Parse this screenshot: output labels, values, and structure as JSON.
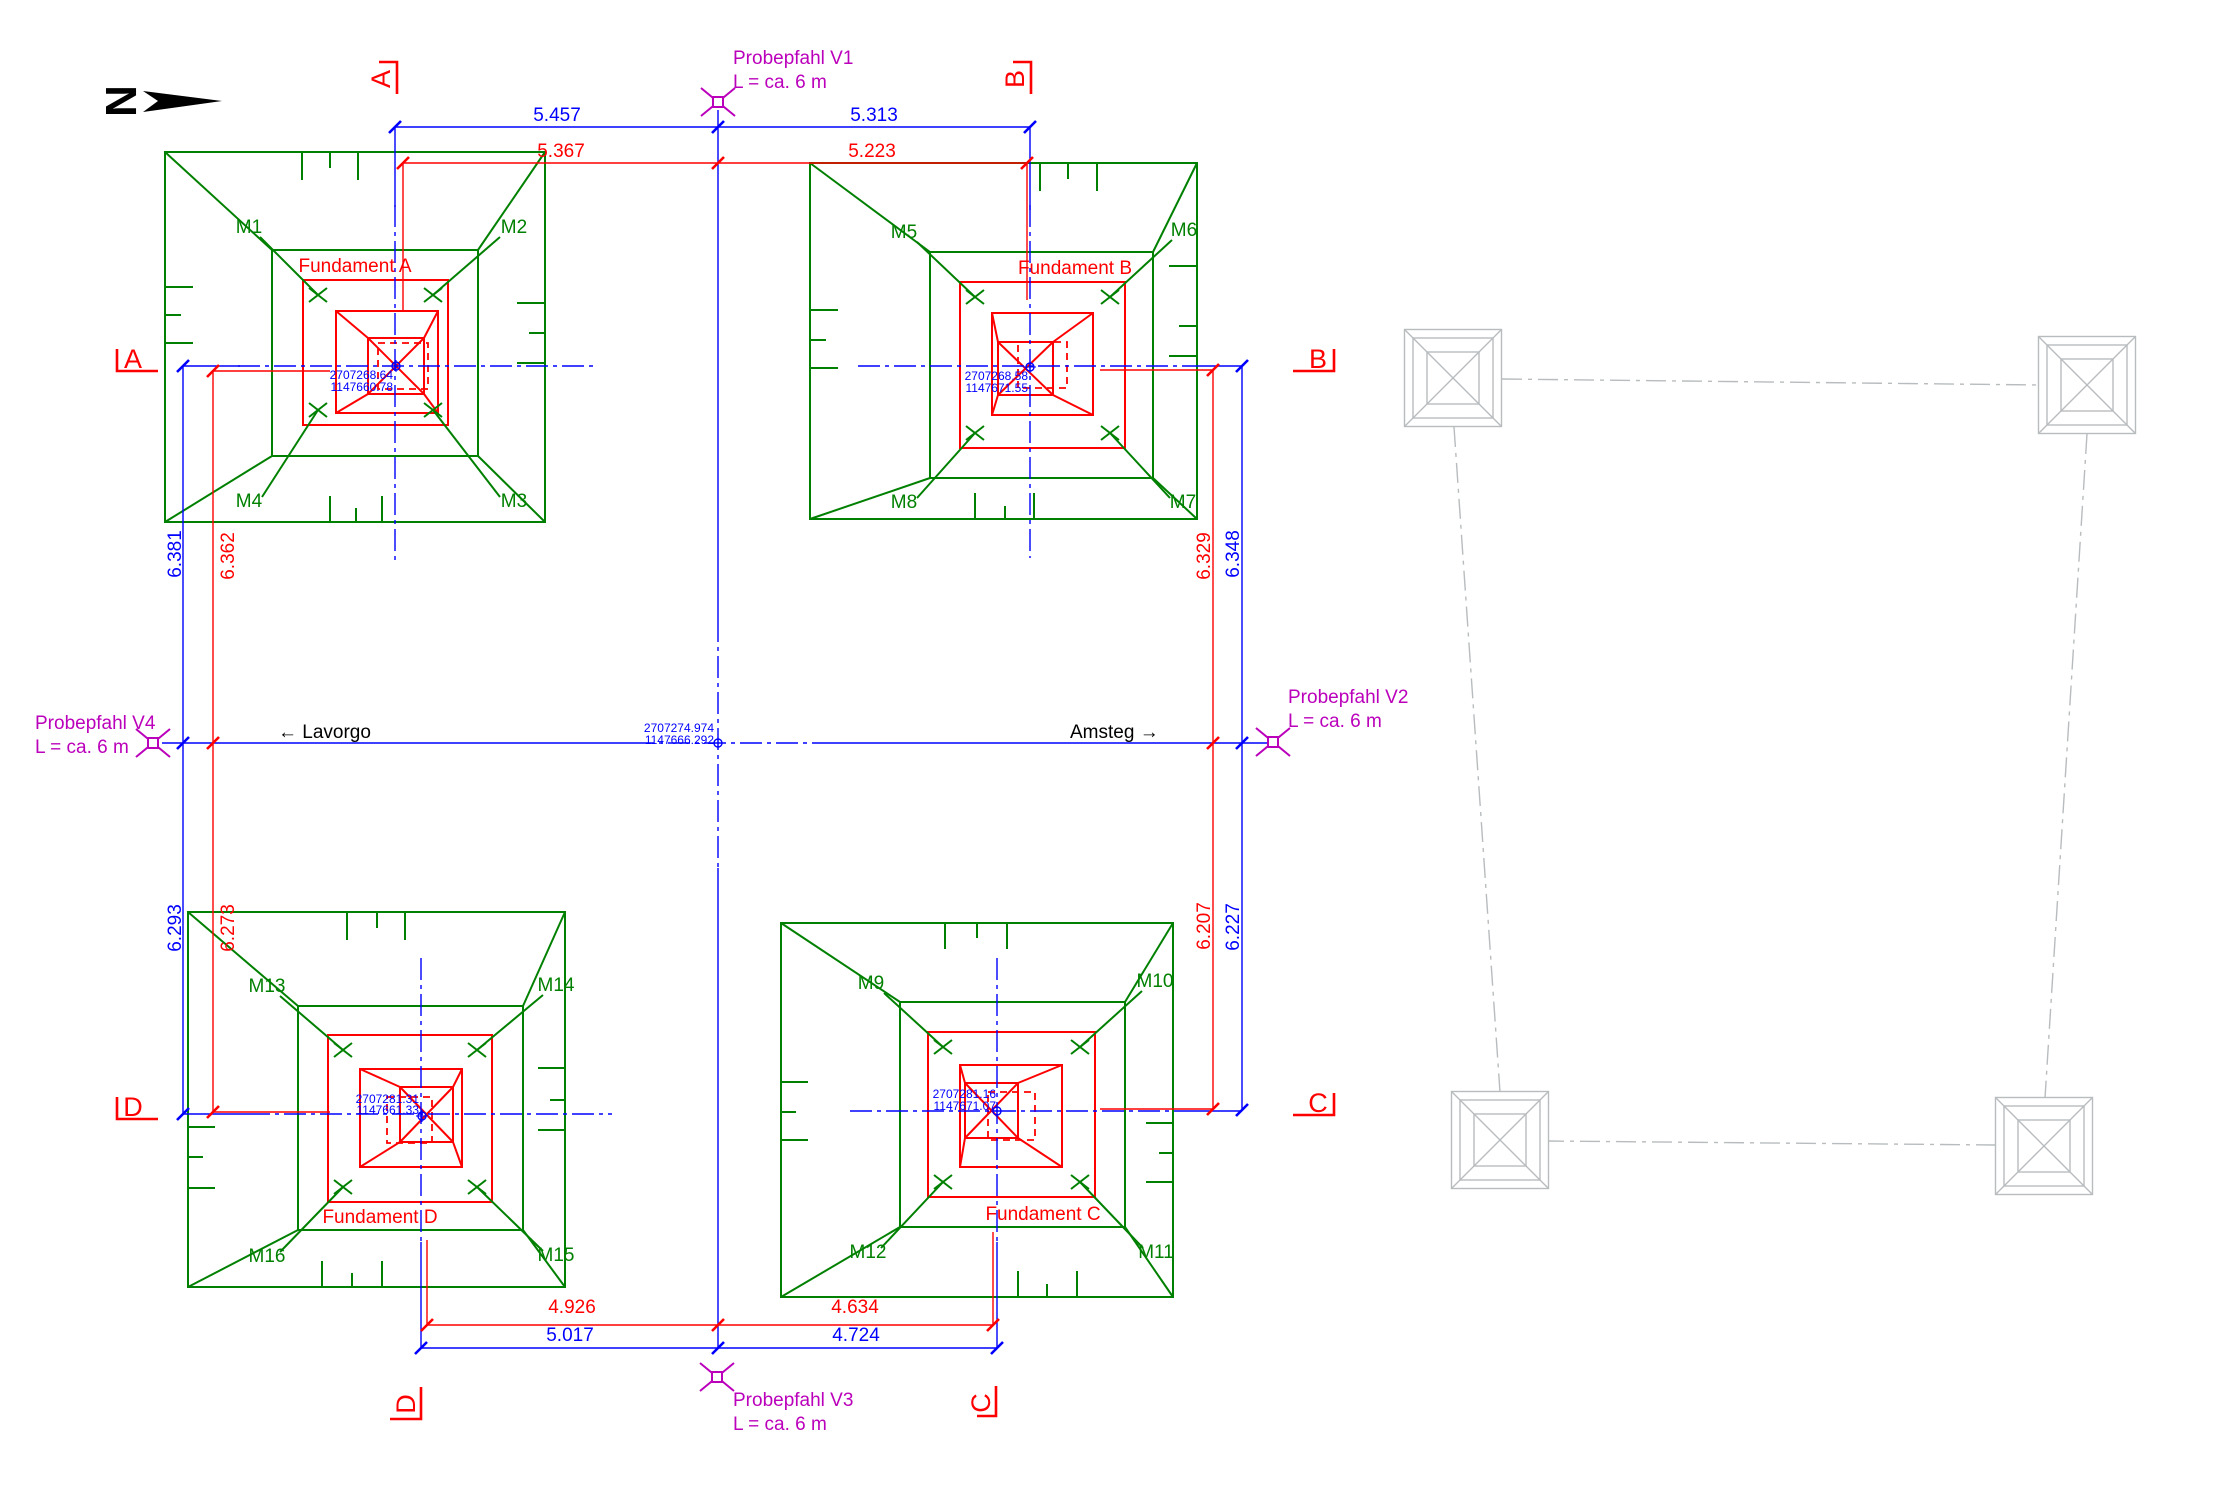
{
  "colors": {
    "excavation_green": "#008000",
    "foundation_red": "#ff0000",
    "axis_blue": "#0000ff",
    "pile_magenta": "#bb00bb",
    "ghost_gray": "#b8bcbe",
    "black": "#000000"
  },
  "north": {
    "label": "N"
  },
  "sections": {
    "top_a": "A",
    "top_b": "B",
    "left_a": "A",
    "right_b": "B",
    "left_d": "D",
    "right_c": "C",
    "bottom_d": "D",
    "bottom_c": "C"
  },
  "routes": {
    "left": "← Lavorgo",
    "right": "Amsteg →"
  },
  "piles": {
    "v1": {
      "name": "Probepfahl V1",
      "len": "L = ca. 6 m"
    },
    "v2": {
      "name": "Probepfahl V2",
      "len": "L = ca. 6 m"
    },
    "v3": {
      "name": "Probepfahl V3",
      "len": "L = ca. 6 m"
    },
    "v4": {
      "name": "Probepfahl V4",
      "len": "L = ca. 6 m"
    }
  },
  "center": {
    "e": "2707274.974",
    "n": "1147666.292"
  },
  "foundations": {
    "a": {
      "label": "Fundament A",
      "e": "2707268.64",
      "n": "1147660.78"
    },
    "b": {
      "label": "Fundament B",
      "e": "2707268.58",
      "n": "1147671.55"
    },
    "c": {
      "label": "Fundament C",
      "e": "2707281.16",
      "n": "1147671.07"
    },
    "d": {
      "label": "Fundament D",
      "e": "2707281.31",
      "n": "1147661.33"
    }
  },
  "markers": {
    "m1": "M1",
    "m2": "M2",
    "m3": "M3",
    "m4": "M4",
    "m5": "M5",
    "m6": "M6",
    "m7": "M7",
    "m8": "M8",
    "m9": "M9",
    "m10": "M10",
    "m11": "M11",
    "m12": "M12",
    "m13": "M13",
    "m14": "M14",
    "m15": "M15",
    "m16": "M16"
  },
  "dims": {
    "top_blue_left": "5.457",
    "top_blue_right": "5.313",
    "top_red_left": "5.367",
    "top_red_right": "5.223",
    "left_blue_up": "6.381",
    "left_red_up": "6.362",
    "left_blue_low": "6.293",
    "left_red_low": "6.273",
    "right_red_up": "6.329",
    "right_blue_up": "6.348",
    "right_red_low": "6.207",
    "right_blue_low": "6.227",
    "bottom_red_left": "4.926",
    "bottom_blue_left": "5.017",
    "bottom_red_right": "4.634",
    "bottom_blue_right": "4.724"
  }
}
